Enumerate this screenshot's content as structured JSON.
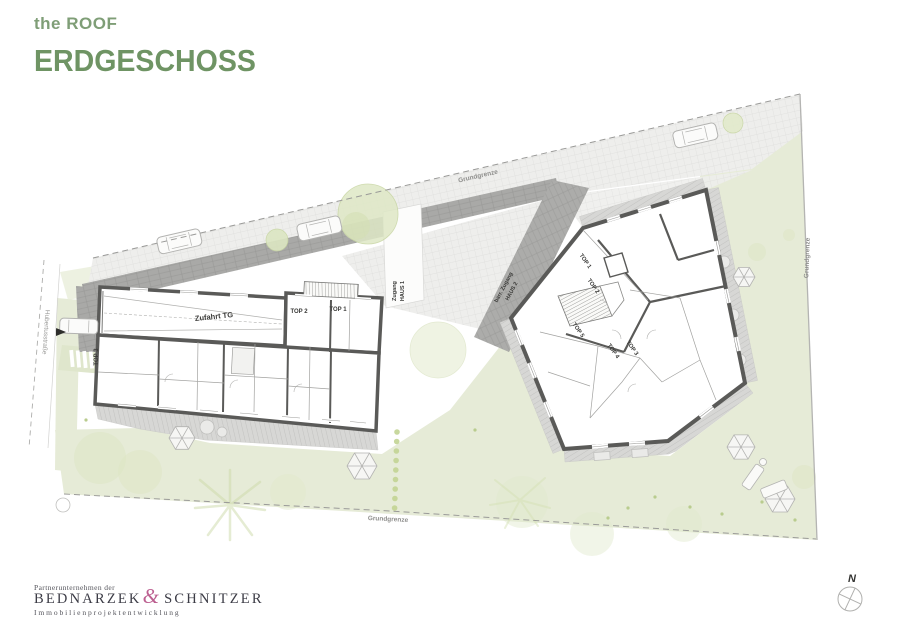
{
  "header": {
    "project": "the ROOF",
    "floor": "ERDGESCHOSS"
  },
  "plan": {
    "street_label": "Hubertusstraße",
    "boundary": {
      "top": "Grundgrenze",
      "right": "Grundgrenze",
      "bottom": "Grundgrenze"
    },
    "haus1": {
      "garage_label": "Zufahrt TG",
      "top1": "TOP 1",
      "top2": "TOP 2",
      "top3": "TOP 3",
      "access_line1": "Zugang",
      "access_line2": "HAUS 1"
    },
    "haus2": {
      "top1": "TOP 1",
      "top2": "TOP 2",
      "top3": "TOP 3",
      "top4": "TOP 4",
      "top5": "TOP 5",
      "access_line1": "barr. Zugang",
      "access_line2": "HAUS 2"
    },
    "compass_label": "N"
  },
  "footer": {
    "partner": "Partnerunternehmen der",
    "brand_first": "BEDNARZEK",
    "brand_amp": "&",
    "brand_second": "SCHNITZER",
    "tagline": "Immobilienprojektentwicklung"
  },
  "colors": {
    "title_green": "#6f9464",
    "lawn": "#e6ebd7",
    "wall_gray": "#5a5a58",
    "path_gray": "#a9a9a7",
    "logo_pink": "#bc5f90"
  }
}
